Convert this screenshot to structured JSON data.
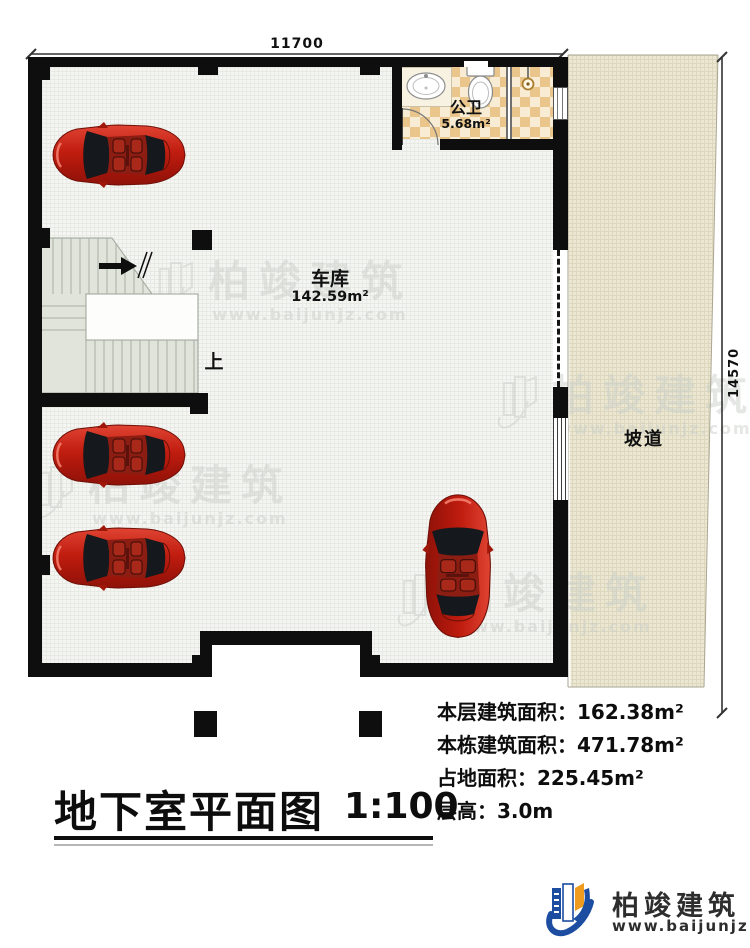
{
  "plan": {
    "dimensions": {
      "top": "11700",
      "right": "14570"
    },
    "rooms": {
      "garage": {
        "name": "车库",
        "area": "142.59m²"
      },
      "bathroom": {
        "name": "公卫",
        "area": "5.68m²"
      },
      "ramp": {
        "name": "坡道"
      }
    },
    "stair": {
      "up_label": "上"
    }
  },
  "title_block": {
    "title": "地下室平面图",
    "scale": "1:100",
    "stats": [
      "本层建筑面积：162.38m²",
      "本栋建筑面积：471.78m²",
      "占地面积：225.45m²",
      "层高：3.0m"
    ]
  },
  "branding": {
    "company": "柏竣建筑",
    "website": "www.baijunjz.com"
  },
  "watermark": {
    "text": "柏竣建筑",
    "website": "www.baijunjz.com"
  },
  "colors": {
    "wall": "#0e0e0e",
    "floor": "#f5f6f3",
    "ramp": "#ebe7d2",
    "stair": "#e0e4da",
    "bath_tile_dark": "#eac68c",
    "bath_tile_light": "#f8edd4",
    "car_red": "#c8281c",
    "logo_blue": "#1c4da1",
    "logo_orange": "#ee9b1e",
    "watermark_gray": "#ccd0cb"
  }
}
